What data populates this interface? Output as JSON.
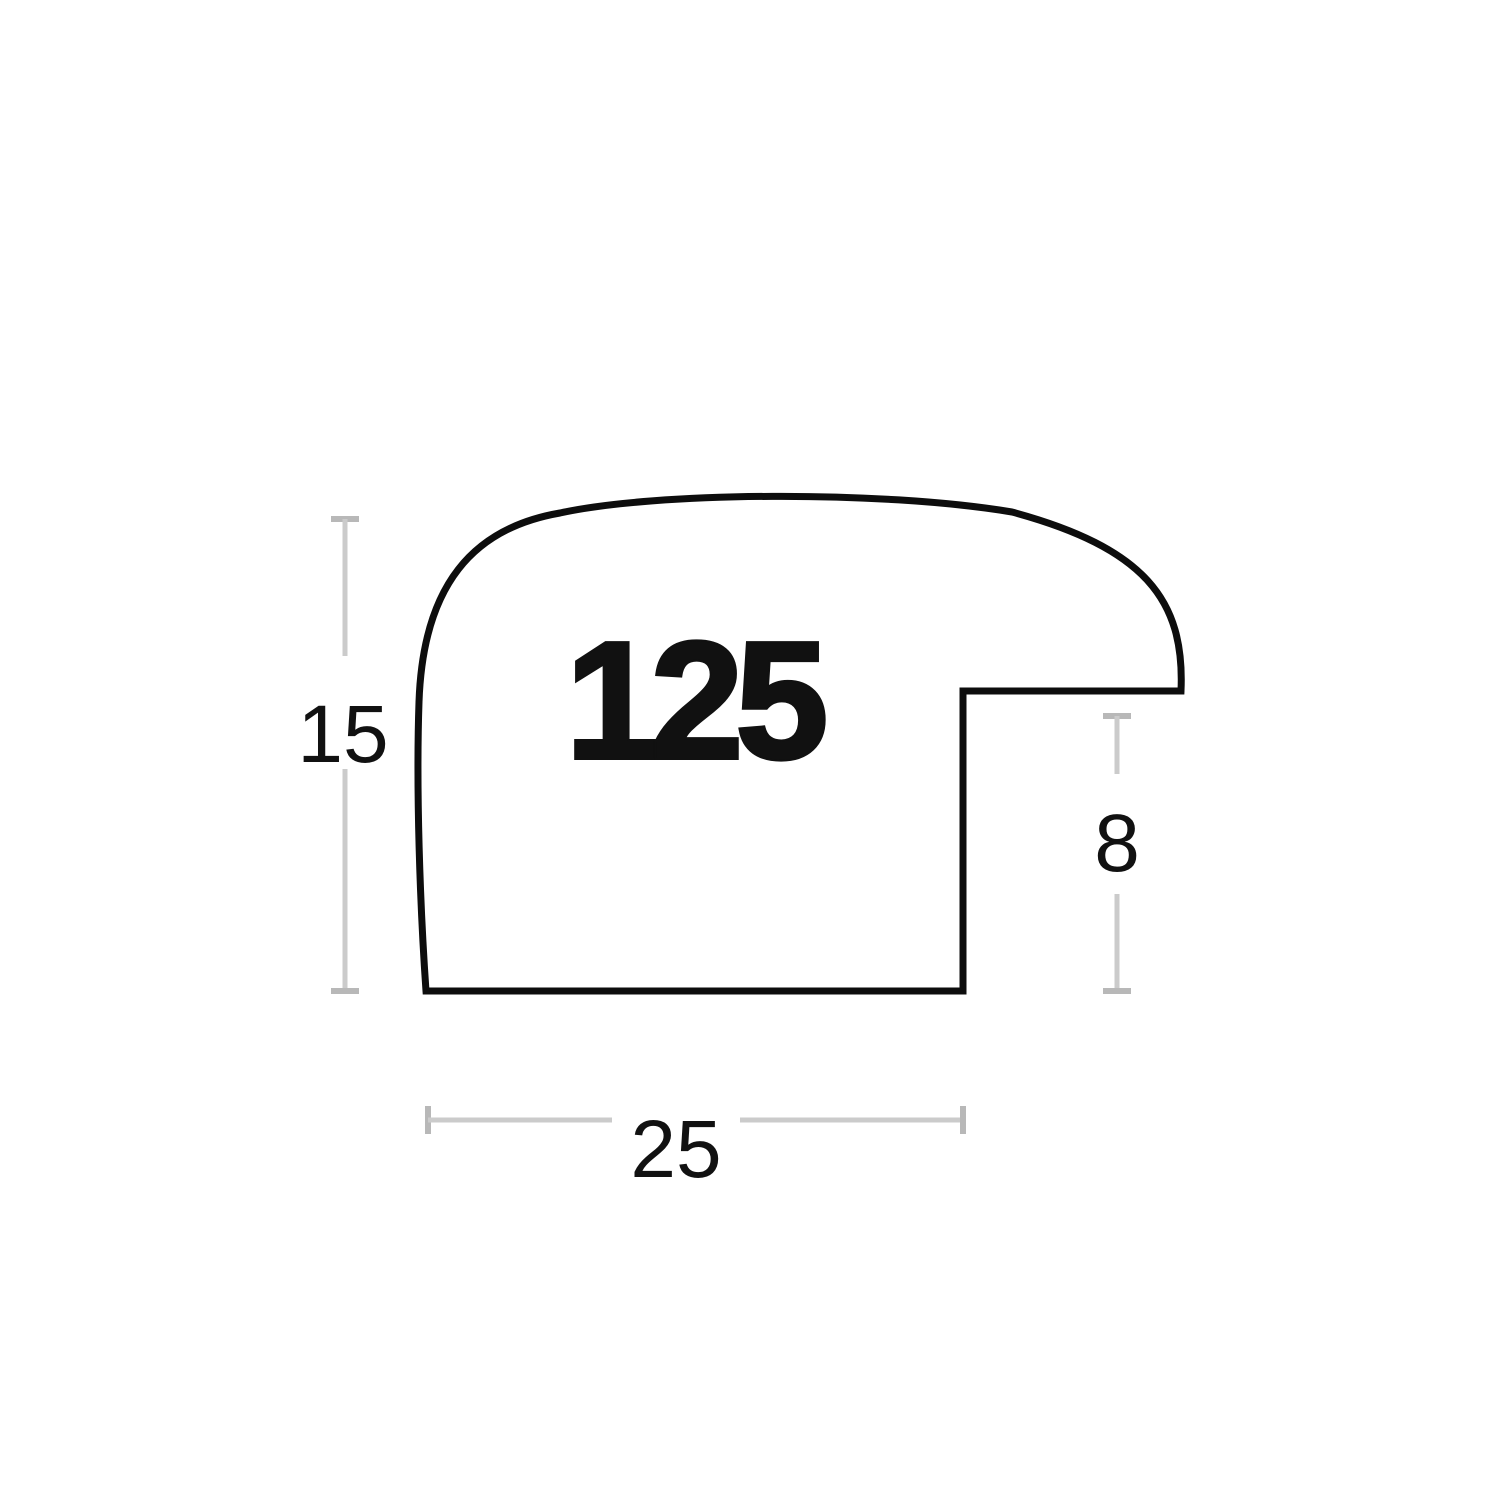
{
  "canvas": {
    "width": 1500,
    "height": 1500,
    "background": "#ffffff"
  },
  "colors": {
    "outline": "#0d0d0d",
    "dimension_line": "#cbcbcb",
    "dimension_cap": "#b8b8b8",
    "label_text": "#111111"
  },
  "figure": {
    "type": "picture-frame-moulding-profile-cross-section"
  },
  "profile": {
    "number_label": "125"
  },
  "dimensions": {
    "height_label": "15",
    "rebate_depth_label": "8",
    "width_label": "25"
  }
}
